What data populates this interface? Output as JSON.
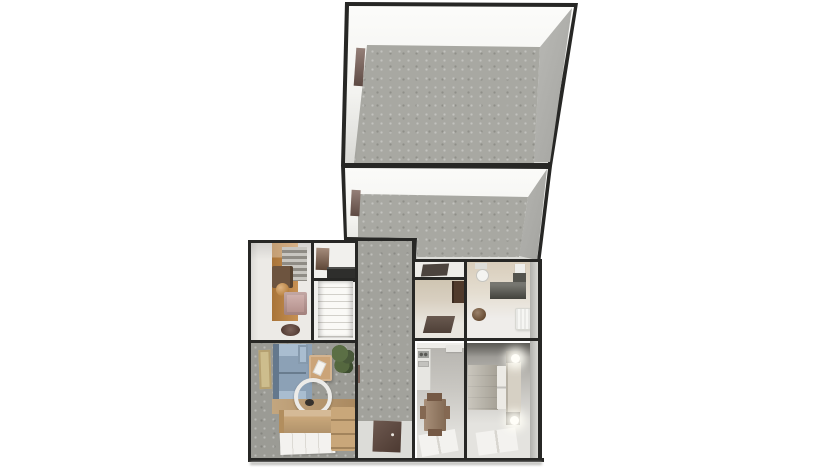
{
  "scene": {
    "type": "3d-dollhouse-floor-plan",
    "background": "#ffffff",
    "view": "top-down perspective, no visible text or UI chrome"
  },
  "palette": {
    "background": "#ffffff",
    "wall_outline": "#272725",
    "wall_inner_white": "#f4f3f0",
    "wall_face_gray": "#c6c6c2",
    "carpet_upper": "#a8a8a2",
    "carpet_hall": "#a2a29c",
    "carpet_living": "#9b9b95",
    "floor_light": "#eceae6",
    "floor_entry": "#dcdcd8",
    "doorway_brown": "#7d635a",
    "wood_orange": "#c08440",
    "rug_stripe_gray": "#aba79f",
    "door_mat_brown": "#5d463c",
    "dark_mat": "#4c443e",
    "sofa_blue": "#8ca1b6",
    "sofa_blue_dark": "#64788d",
    "sofa_blue_light": "#a9bdd0",
    "sofa_tan": "#c9a77a",
    "table_tan": "#cba478",
    "chair_pink": "#c59d98",
    "stool_orange": "#c8822f",
    "dresser_brown": "#6d543f",
    "pet_bed_brown": "#5f4136",
    "plant_green": "#51643d",
    "mirror_ring": "#ecebe8",
    "rug_white": "#f3f2ef",
    "stairs_white": "#f5f4f1",
    "stair_void": "#2e2e2c",
    "picture_brown": "#86654f",
    "closet_beige": "#d3c9b8",
    "wardrobe_brown": "#503a2b",
    "pouf_brown": "#6f4a28",
    "vanity_dark": "#585850",
    "porcelain_white": "#f4f4f1",
    "heater_white": "#f6f6f3",
    "counter_white": "#e7e6e2",
    "dining_table_brown": "#997c62",
    "dining_chair_brown": "#755945",
    "bed_duvet": "#b8b3a7",
    "bed_pillow": "#eceae5",
    "bed_headboard": "#d6d0c4",
    "nightstand_gray": "#8b867d",
    "lamp_glow": "#fffef8"
  },
  "floor_plan": {
    "upper_rooms": [
      {
        "name": "back room (unfurnished)",
        "floor": "grey carpet",
        "walls": "white",
        "features": [
          "doorway mark on left wall"
        ]
      },
      {
        "name": "front room (unfurnished)",
        "floor": "grey carpet",
        "walls": "white",
        "features": [
          "doorway mark on left wall"
        ]
      }
    ],
    "lower_rooms": [
      {
        "name": "study",
        "furniture": [
          "orange wood floor runner",
          "grey striped rug",
          "dark dresser",
          "round orange stool",
          "pink armchair",
          "oval pet bed"
        ]
      },
      {
        "name": "staircase",
        "furniture": [
          "brown wall picture",
          "dark stair opening",
          "white steps"
        ]
      },
      {
        "name": "living room",
        "furniture": [
          "wall art",
          "blue corner sofa",
          "coffee table with magazine",
          "potted plant",
          "round mirror",
          "wood floor strip",
          "beige sofa",
          "beige chaise",
          "white striped rug"
        ]
      },
      {
        "name": "hallway",
        "furniture": [
          "grey carpet",
          "entry floor",
          "dark brown door mat"
        ]
      },
      {
        "name": "closet nook",
        "furniture": [
          "dark mat",
          "wardrobe",
          "dark rug"
        ]
      },
      {
        "name": "bathroom",
        "furniture": [
          "toilet",
          "wall basin",
          "dark vanity",
          "round pouf",
          "white heater"
        ]
      },
      {
        "name": "kitchen-diner",
        "furniture": [
          "kitchen counter",
          "cooktop",
          "dining table",
          "chairs",
          "white rug"
        ]
      },
      {
        "name": "bedroom",
        "furniture": [
          "double bed with grey duvet",
          "two nightstands",
          "two lit lamps",
          "white rug"
        ]
      }
    ]
  }
}
